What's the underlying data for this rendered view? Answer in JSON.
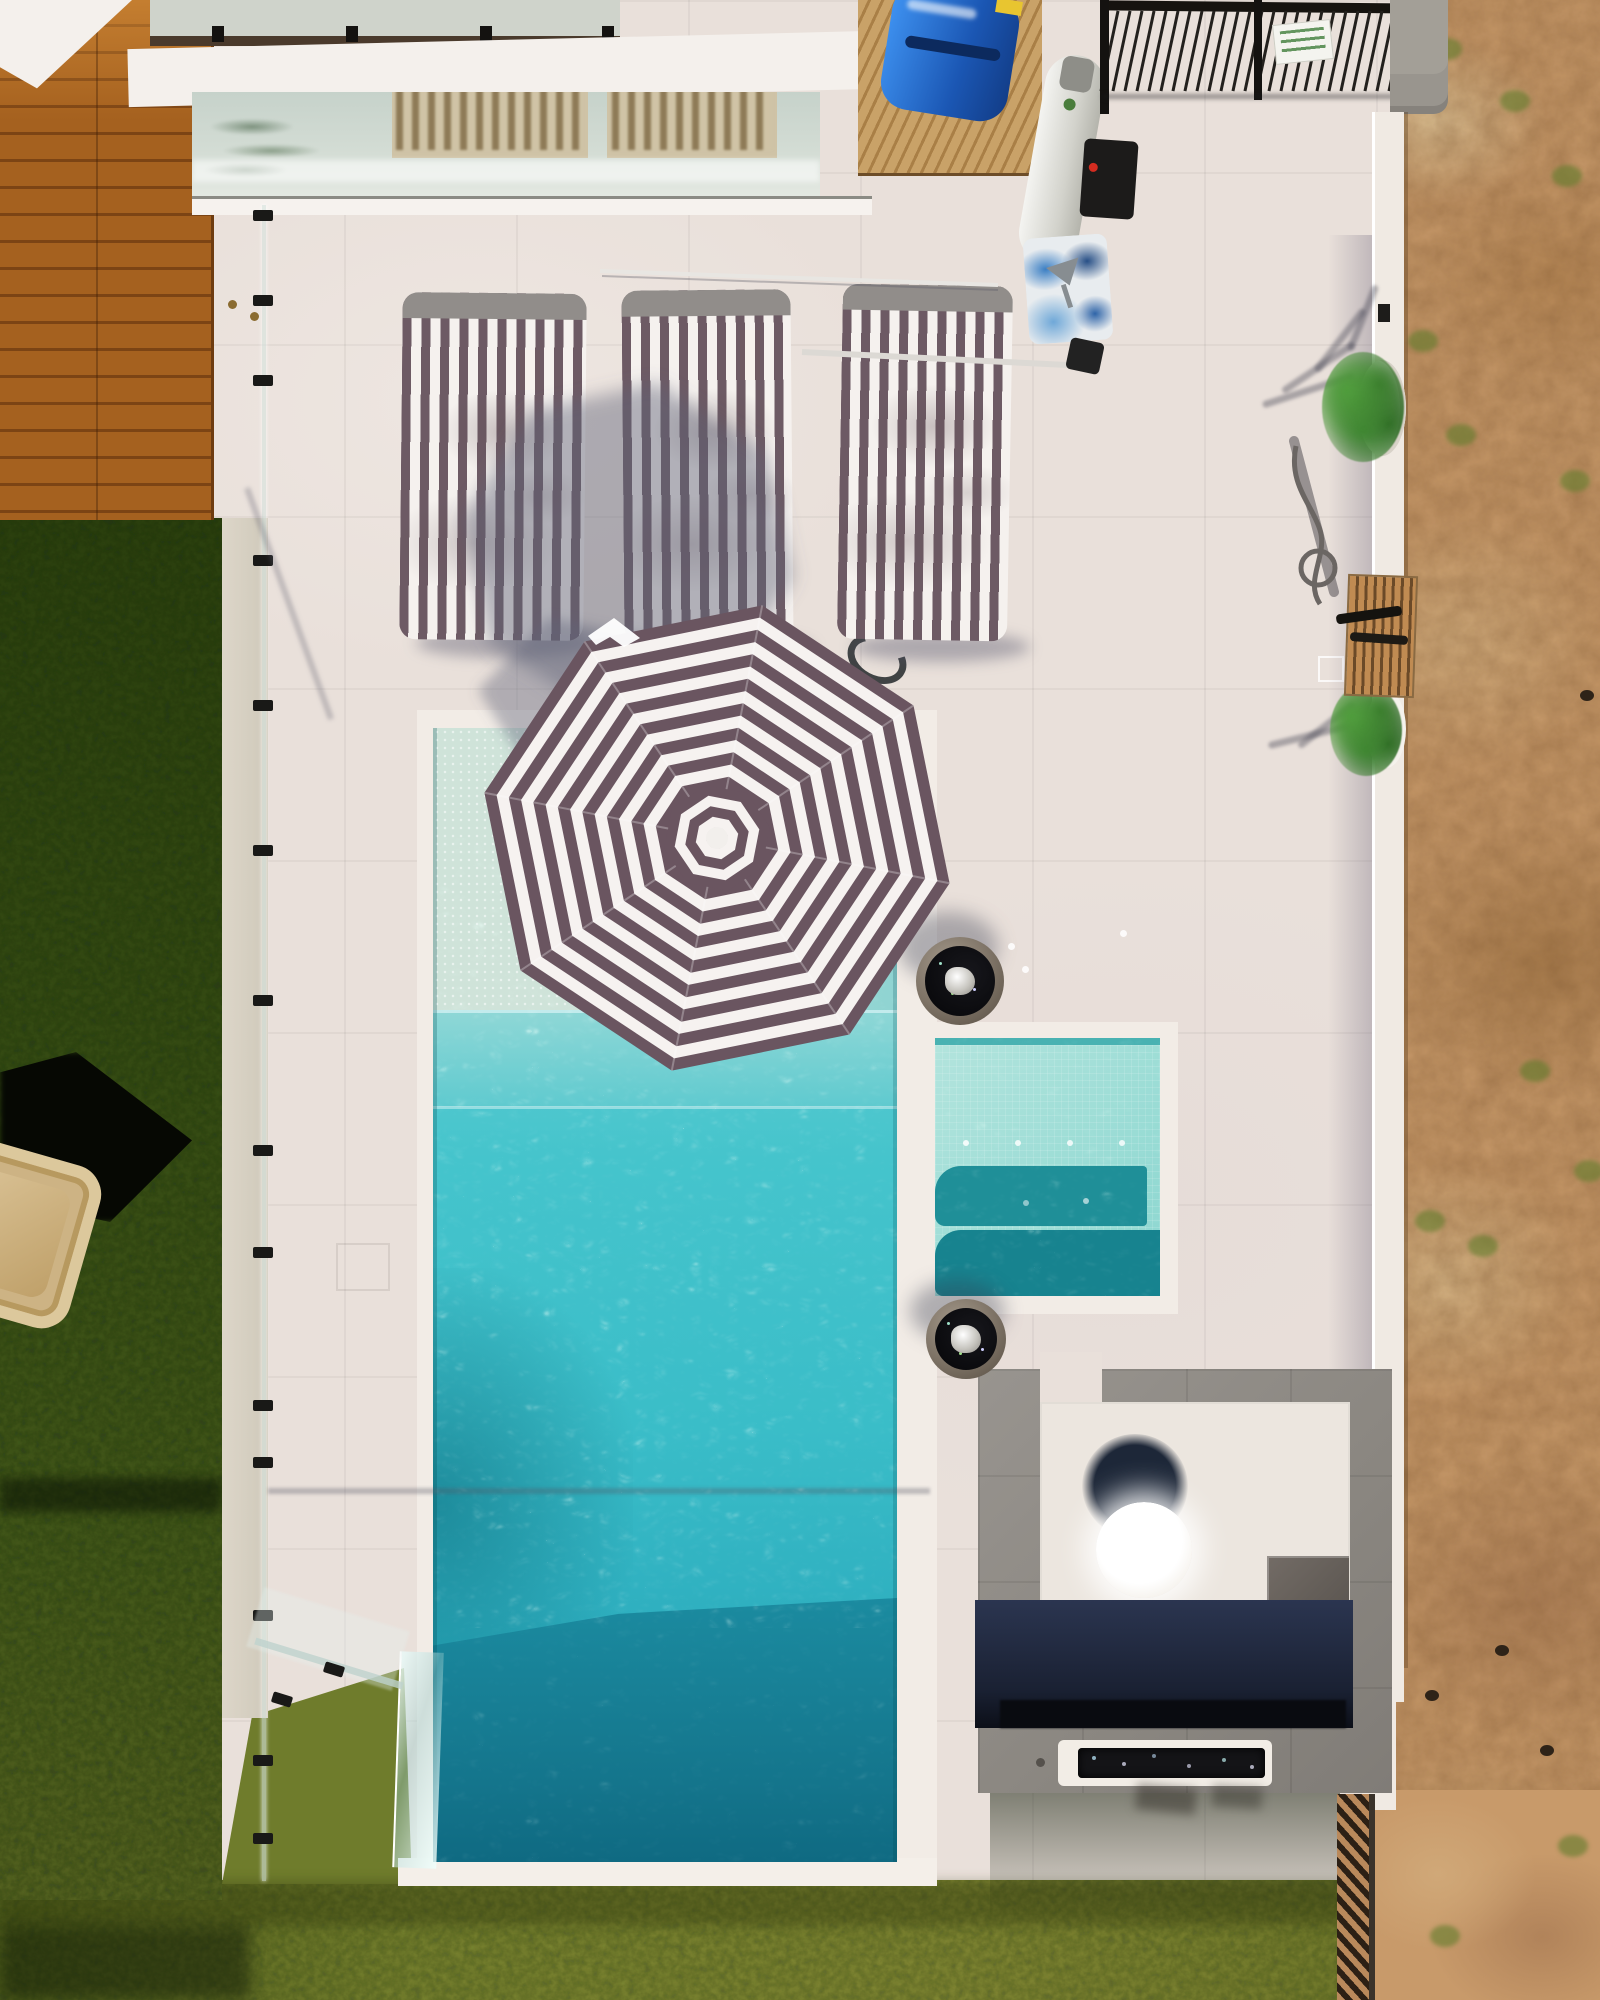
{
  "scene": {
    "type": "aerial-drone-photo",
    "description": "Top-down aerial view of a modern coastal backyard: white paved pool deck with striped umbrella, three striped lounge cushions, turquoise plunge pool with tanning ledge, attached spa with submerged benches, two round fire bowls, grey-tiled fire-pit lounge with white table and linear fire trough, glass pool fence, artificial turf, timber deck, outdoor shower, and bare sandy ground on the right."
  },
  "palette": {
    "paving": "#e9e0da",
    "paving-shadow": "#9d9cb4",
    "water-main": "#3ec5cd",
    "water-deep": "#14758c",
    "water-ledge": "#cfe3d9",
    "spa-water": "#a5ded7",
    "spa-bench": "#1f8f98",
    "umb-dark": "#6a5560",
    "umb-light": "#f6f2f0",
    "cush-dark": "#6d5a64",
    "cush-light": "#f5f1ee",
    "grass-dark": "#374f15",
    "grass-olive": "#7f8a33",
    "sand": "#c89a6a",
    "wood": "#9c5a22",
    "tile-gray": "#8f8b86",
    "platform-white": "#ece6df",
    "shadow-navy": "#1f2740",
    "fire-black": "#141417",
    "kayak-blue": "#2f83e8",
    "plant-green": "#3d8530"
  },
  "objects": {
    "umbrella": {
      "label": "octagonal striped pool umbrella",
      "center": [
        717,
        838
      ],
      "radius": 237,
      "rotation": 11,
      "rings": 19,
      "cap_radius": 54,
      "cap_rings": 5
    },
    "umbrella_shadow": {
      "label": "umbrella shadow on deck",
      "center": [
        628,
        548
      ],
      "radius": 168,
      "rotation": 10
    },
    "lounge_cushions": {
      "label": "striped lounger cushions",
      "count": 3
    },
    "pool": {
      "label": "turquoise plunge pool with tanning ledge and infinity glass corner"
    },
    "spa": {
      "label": "attached spa with mosaic tiles and submerged benches"
    },
    "fire_bowls": {
      "label": "round fire bowls with black fire-glass and steel burners",
      "count": 2
    },
    "fire_trough": {
      "label": "linear in-ground fire pit with black coals"
    },
    "round_table": {
      "label": "white round fire table on white platform"
    },
    "tile_lounge": {
      "label": "grey porcelain tiled lounge area"
    },
    "glass_fence": {
      "label": "frameless glass pool fence",
      "clamp_ys": [
        215,
        300,
        380,
        560,
        705,
        850,
        1000,
        1150,
        1252,
        1405,
        1462,
        1615,
        1760,
        1838
      ]
    },
    "railing": {
      "label": "black metal balustrade, upper terrace",
      "bar_count": 26
    },
    "sign": {
      "label": "small compliance sign on railing, illegible green print"
    },
    "kayak": {
      "label": "blue kayak / pool cover bundle"
    },
    "gas_cylinder": {
      "label": "white LPG gas bottle"
    },
    "equipment_box": {
      "label": "black pool equipment box with red indicator"
    },
    "cooler_bag": {
      "label": "blue and white printed cooler bag"
    },
    "hose_coil": {
      "label": "dark pool hose coil on deck"
    },
    "cleaning_poles": {
      "label": "telescopic pool cleaning poles lying on deck",
      "count": 2
    },
    "outdoor_shower": {
      "label": "outdoor shower with coiled hose and timber duckboard"
    },
    "planters": {
      "label": "round white planter bowls with green shrubs",
      "count": 2
    },
    "wicker_chair": {
      "label": "wicker lounge chair on turf with hard shadow"
    },
    "wood_deck": {
      "label": "timber deck boards, top left"
    },
    "house_window": {
      "label": "glass roof / window strip reflecting palm and neighbouring facade"
    },
    "balcony": {
      "label": "upper balcony with frosted glass balustrade"
    },
    "turf": {
      "label": "artificial turf strip, left"
    },
    "lawn": {
      "label": "patchy natural lawn, bottom"
    },
    "sand_lot": {
      "label": "bare sandy ground, right side",
      "weeds": [
        [
          1432,
          38
        ],
        [
          1500,
          90
        ],
        [
          1552,
          165
        ],
        [
          1408,
          330
        ],
        [
          1446,
          424
        ],
        [
          1560,
          470
        ],
        [
          1520,
          1060
        ],
        [
          1574,
          1160
        ],
        [
          1468,
          1235
        ],
        [
          1415,
          1210
        ],
        [
          1558,
          1835
        ],
        [
          1430,
          1925
        ]
      ],
      "rocks": [
        [
          1425,
          1690
        ],
        [
          1495,
          1645
        ],
        [
          1540,
          1745
        ],
        [
          1580,
          690
        ]
      ]
    },
    "white_boundary_wall": {
      "label": "white rendered boundary wall, right"
    },
    "timber_fence": {
      "label": "timber slat fence section, bottom right"
    },
    "water_drops": [
      [
        1008,
        943
      ],
      [
        1022,
        966
      ],
      [
        1120,
        930
      ]
    ]
  }
}
